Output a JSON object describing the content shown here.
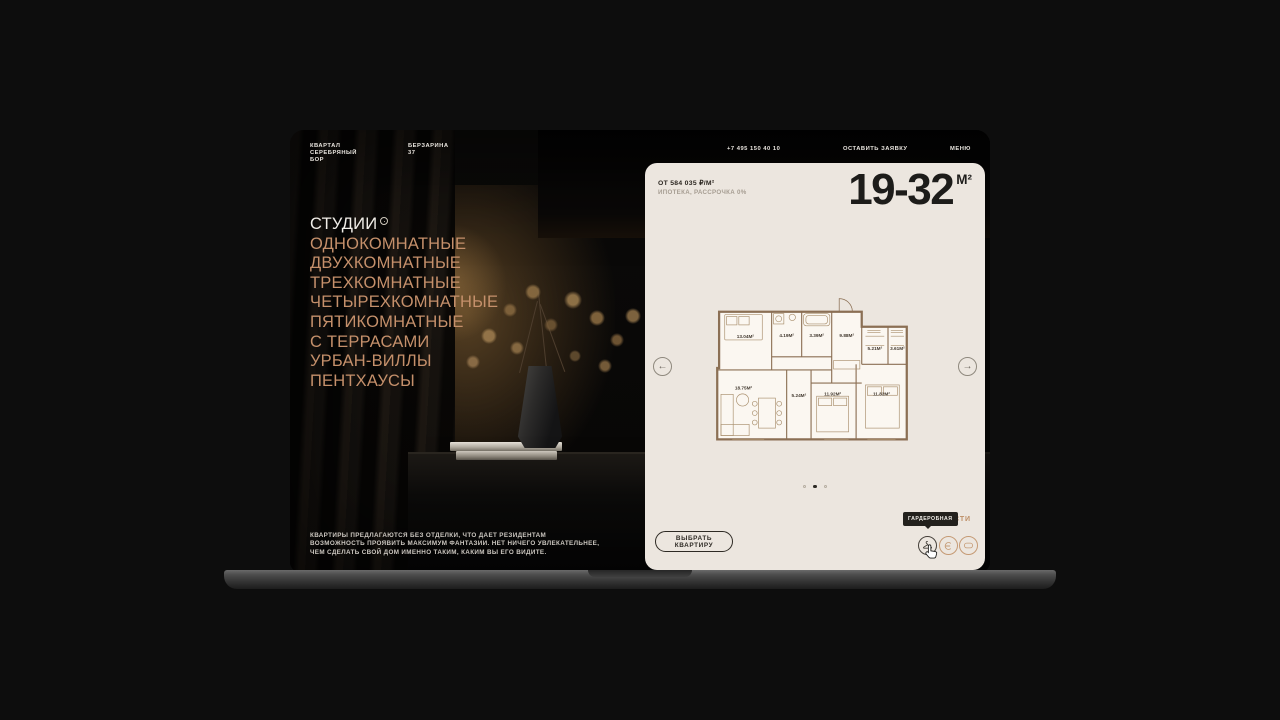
{
  "brand": {
    "lines": [
      "КВАРТАЛ",
      "СЕРЕБРЯНЫЙ",
      "БОР"
    ]
  },
  "nav": {
    "address_lines": [
      "БЕРЗАРИНА",
      "37"
    ],
    "phone": "+7 495 150 40 10",
    "request_button": "ОСТАВИТЬ ЗАЯВКУ",
    "menu_button": "МЕНЮ"
  },
  "catalog": {
    "active_item": {
      "label": "СТУДИИ",
      "badge_icon": "circle-badge"
    },
    "items": [
      "ОДНОКОМНАТНЫЕ",
      "ДВУХКОМНАТНЫЕ",
      "ТРЕХКОМНАТНЫЕ",
      "ЧЕТЫРЕХКОМНАТНЫЕ",
      "ПЯТИКОМНАТНЫЕ",
      "С ТЕРРАСАМИ",
      "УРБАН-ВИЛЛЫ",
      "ПЕНТХАУСЫ"
    ],
    "description": "КВАРТИРЫ ПРЕДЛАГАЮТСЯ БЕЗ ОТДЕЛКИ, ЧТО ДАЕТ РЕЗИДЕНТАМ ВОЗМОЖНОСТЬ ПРОЯВИТЬ МАКСИМУМ ФАНТАЗИИ. НЕТ НИЧЕГО УВЛЕКАТЕЛЬНЕЕ, ЧЕМ СДЕЛАТЬ СВОЙ ДОМ ИМЕННО ТАКИМ, КАКИМ ВЫ ЕГО ВИДИТЕ."
  },
  "panel": {
    "price": "ОТ 584 035 ₽/М²",
    "terms": "ИПОТЕКА, РАССРОЧКА 0%",
    "area_range": "19-32",
    "area_unit": "М²",
    "floor_plan": {
      "room_areas": [
        "13.04М²",
        "4.19М²",
        "3.39М²",
        "9.88М²",
        "5.21М²",
        "3.61М²",
        "18.75М²",
        "5.24М²",
        "11.92М²",
        "11.82М²"
      ]
    },
    "carousel": {
      "prev_icon": "arrow-left-circle",
      "next_icon": "arrow-right-circle",
      "dots_total": 3,
      "active_dot": 2
    },
    "select_button": "ВЫБРАТЬ КВАРТИРУ",
    "features": {
      "label": "ОСОБЕННОСТИ",
      "tooltip": "ГАРДЕРОБНАЯ",
      "icons": [
        "hanger-icon",
        "loggia-icon",
        "window-icon"
      ]
    },
    "arrows": {
      "prev": "←",
      "next": "→"
    }
  },
  "colors": {
    "page_background": "#0d0d0d",
    "accent_tan": "#c5906b",
    "panel_background": "#ece6df",
    "text_dark": "#2b2620",
    "tooltip_background": "#23211d"
  }
}
